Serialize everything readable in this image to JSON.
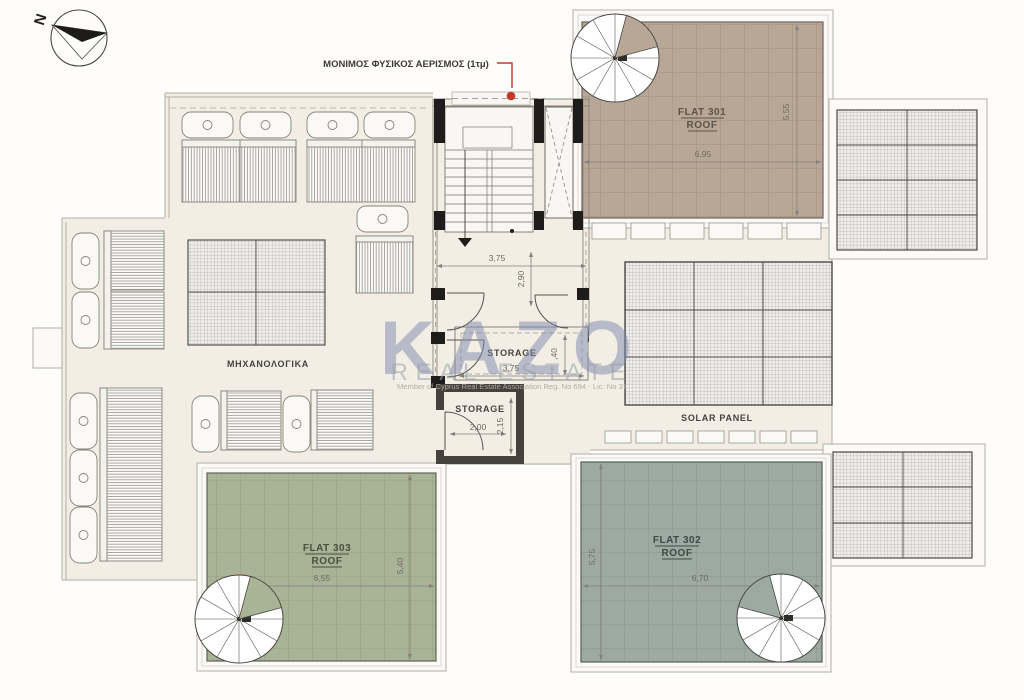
{
  "compass": {
    "north_label": "N"
  },
  "annotations": {
    "vent_note": "ΜΟΝΙΜΟΣ ΦΥΣΙΚΟΣ ΑΕΡΙΣΜΟΣ (1τμ)",
    "accent_red": "#c2392b"
  },
  "plan": {
    "flats": {
      "f301": {
        "name": "FLAT 301",
        "type": "ROOF",
        "width": "6,95",
        "height": "5,55",
        "color": "#b8a796"
      },
      "f302": {
        "name": "FLAT 302",
        "type": "ROOF",
        "width": "6,70",
        "height": "5,75",
        "color": "#9da9a3"
      },
      "f303": {
        "name": "FLAT 303",
        "type": "ROOF",
        "width": "6,55",
        "height": "5,40",
        "color": "#a9b396"
      }
    },
    "stair_core": {
      "width": "3,75",
      "depth": "2,90"
    },
    "storage_upper": {
      "label": "STORAGE",
      "width": "3,75",
      "depth": ",40"
    },
    "storage_lower": {
      "label": "STORAGE",
      "width": "2,00",
      "depth": "2,15"
    },
    "mechanical_label": "ΜΗΧΑΝΟΛΟΓΙΚΑ",
    "solar_label": "SOLAR PANEL"
  },
  "watermark": {
    "brand": "KAZO",
    "tagline": "REAL ESTATE",
    "registration": "Member of Cyprus Real Estate Association      Reg. No 694 - Lic. No 37"
  }
}
